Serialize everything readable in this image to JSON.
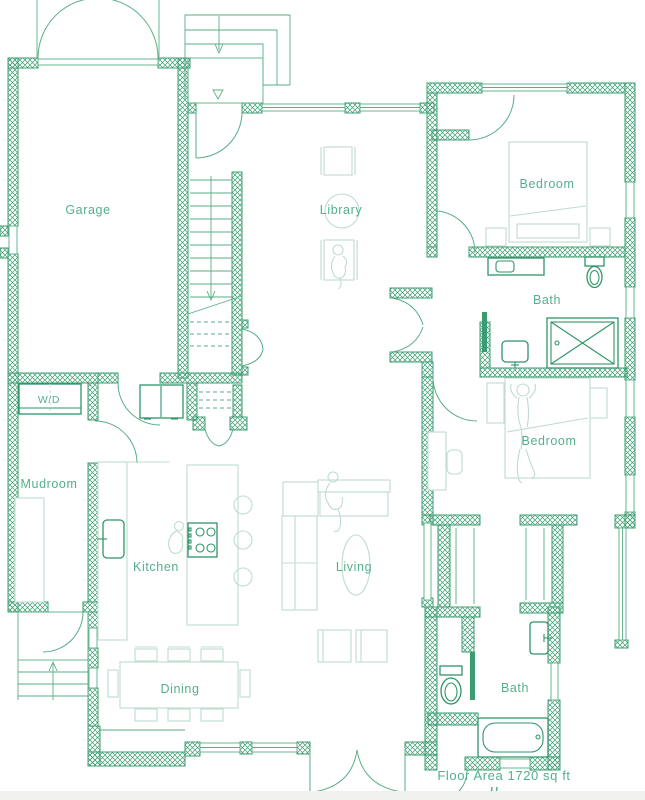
{
  "floor_plan": {
    "rooms": [
      {
        "name": "garage",
        "label": "Garage"
      },
      {
        "name": "library",
        "label": "Library"
      },
      {
        "name": "bedroom-1",
        "label": "Bedroom"
      },
      {
        "name": "bath-1",
        "label": "Bath"
      },
      {
        "name": "bedroom-2",
        "label": "Bedroom"
      },
      {
        "name": "wd",
        "label": "W/D"
      },
      {
        "name": "mudroom",
        "label": "Mudroom"
      },
      {
        "name": "kitchen",
        "label": "Kitchen"
      },
      {
        "name": "living",
        "label": "Living"
      },
      {
        "name": "dining",
        "label": "Dining"
      },
      {
        "name": "bath-2",
        "label": "Bath"
      }
    ],
    "annotations": {
      "floor_area": "Floor Area 1720 sq ft"
    },
    "colors": {
      "wall": "#3a9c70",
      "line": "#58ae85",
      "furniture": "#bfdccd",
      "fixture": "#2f9569",
      "label": "#53b08a",
      "footer": "#f0f0ee",
      "background": "#ffffff"
    }
  }
}
